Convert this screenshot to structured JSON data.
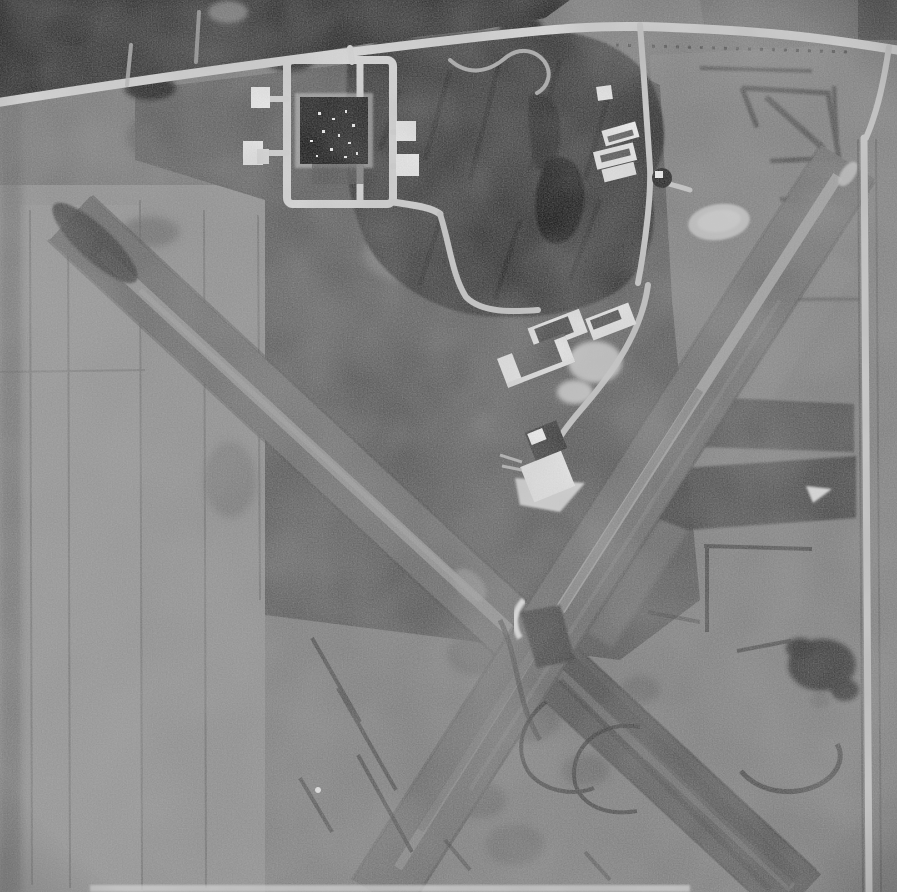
{
  "image": {
    "type": "aerial-photograph",
    "description": "Black-and-white vintage aerial photograph of a small rural airport. Two grass-and-gravel runways cross in an X near the lower center. A light country road runs along the top edge; off it sit a dark-roofed square storage building inside a light apron loop, several small white buildings, a wooded area with a dark pond, a cluster of white hangars mid-frame, an oval light clearing, plowed field patches on the right with dark boundary marks, and mottled farm fields on the left and bottom."
  },
  "palette": {
    "field_base": "#767676",
    "field_light": "#8f8f8f",
    "field_lighter": "#959595",
    "field_mid": "#7e7e7e",
    "field_dark": "#595959",
    "field_top_dark": "#515151",
    "woods": "#222222",
    "woods_center": "#2d2d2d",
    "pond": "#111111",
    "road": "#d8d8d8",
    "road_minor": "#c9c9c9",
    "runway": "#6b6b6b",
    "runway_dark": "#575757",
    "runway_stripe": "#9c9c9c",
    "runway_stripe_bright": "#a8a8a8",
    "building_white": "#f0f0f0",
    "building_dark": "#0e0e0e",
    "hangar_roof_dark": "#3d3d3d",
    "pad_light": "#c0c0c0",
    "mark_dark": "#333333",
    "bright_patch": "#e3e3e3"
  },
  "features": [
    {
      "name": "main-road",
      "label": "country road along top edge"
    },
    {
      "name": "woods-top",
      "label": "tree line along upper edge"
    },
    {
      "name": "woods-center",
      "label": "central woodland"
    },
    {
      "name": "pond",
      "label": "dark pond in woodland"
    },
    {
      "name": "apron-loop",
      "label": "light apron loop around storage building"
    },
    {
      "name": "storage-building",
      "label": "large dark square-roofed building"
    },
    {
      "name": "white-buildings",
      "label": "small white outbuildings"
    },
    {
      "name": "hangar-cluster",
      "label": "white hangars with dark roofs"
    },
    {
      "name": "oval-clearing",
      "label": "light oval clearing"
    },
    {
      "name": "runway-nw-se",
      "label": "runway running northwest to southeast"
    },
    {
      "name": "runway-ne-sw",
      "label": "runway running northeast to southwest"
    },
    {
      "name": "runway-intersection",
      "label": "X crossing of the runways"
    },
    {
      "name": "right-road",
      "label": "road along right edge"
    },
    {
      "name": "field-marks",
      "label": "dark plow and track marks in fields"
    }
  ]
}
